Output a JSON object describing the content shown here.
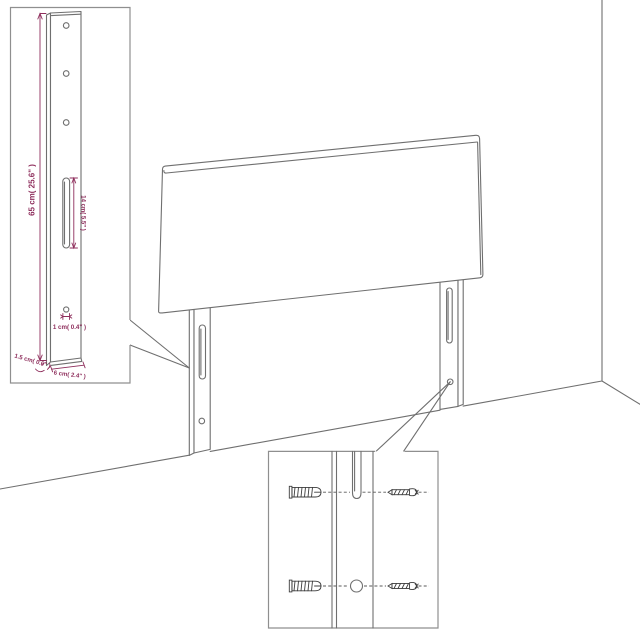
{
  "colors": {
    "accent": "#8e2e5c",
    "line": "#6f6f6f",
    "dark": "#3d3d3d",
    "background": "#ffffff"
  },
  "scene": {
    "subject": "headboard-with-two-legs-against-wall-corner"
  },
  "insets": {
    "leg_detail": {
      "dimensions": {
        "height": "65 cm( 25.6\" )",
        "slot": "14 cm( 5.5\" )",
        "hole": "1 cm( 0.4\" )",
        "thickness": "1.5 cm( 0.6\" )",
        "width": "6 cm( 2.4\" )"
      }
    },
    "mounting_detail": {
      "icons": [
        "wall-plug-icon",
        "screw-icon"
      ]
    }
  }
}
